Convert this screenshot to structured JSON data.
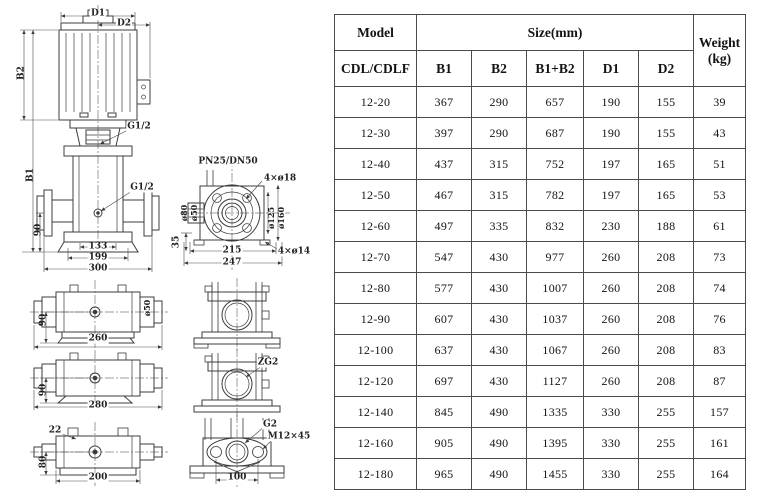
{
  "table": {
    "header": {
      "model": "Model",
      "model_sub": "CDL/CDLF",
      "size_group": "Size(mm)",
      "size_cols": [
        "B1",
        "B2",
        "B1+B2",
        "D1",
        "D2"
      ],
      "weight_l1": "Weight",
      "weight_l2": "(kg)"
    },
    "rows": [
      {
        "model": "12-20",
        "b1": "367",
        "b2": "290",
        "b1b2": "657",
        "d1": "190",
        "d2": "155",
        "w": "39"
      },
      {
        "model": "12-30",
        "b1": "397",
        "b2": "290",
        "b1b2": "687",
        "d1": "190",
        "d2": "155",
        "w": "43"
      },
      {
        "model": "12-40",
        "b1": "437",
        "b2": "315",
        "b1b2": "752",
        "d1": "197",
        "d2": "165",
        "w": "51"
      },
      {
        "model": "12-50",
        "b1": "467",
        "b2": "315",
        "b1b2": "782",
        "d1": "197",
        "d2": "165",
        "w": "53"
      },
      {
        "model": "12-60",
        "b1": "497",
        "b2": "335",
        "b1b2": "832",
        "d1": "230",
        "d2": "188",
        "w": "61"
      },
      {
        "model": "12-70",
        "b1": "547",
        "b2": "430",
        "b1b2": "977",
        "d1": "260",
        "d2": "208",
        "w": "73"
      },
      {
        "model": "12-80",
        "b1": "577",
        "b2": "430",
        "b1b2": "1007",
        "d1": "260",
        "d2": "208",
        "w": "74"
      },
      {
        "model": "12-90",
        "b1": "607",
        "b2": "430",
        "b1b2": "1037",
        "d1": "260",
        "d2": "208",
        "w": "76"
      },
      {
        "model": "12-100",
        "b1": "637",
        "b2": "430",
        "b1b2": "1067",
        "d1": "260",
        "d2": "208",
        "w": "83"
      },
      {
        "model": "12-120",
        "b1": "697",
        "b2": "430",
        "b1b2": "1127",
        "d1": "260",
        "d2": "208",
        "w": "87"
      },
      {
        "model": "12-140",
        "b1": "845",
        "b2": "490",
        "b1b2": "1335",
        "d1": "330",
        "d2": "255",
        "w": "157"
      },
      {
        "model": "12-160",
        "b1": "905",
        "b2": "490",
        "b1b2": "1395",
        "d1": "330",
        "d2": "255",
        "w": "161"
      },
      {
        "model": "12-180",
        "b1": "965",
        "b2": "490",
        "b1b2": "1455",
        "d1": "330",
        "d2": "255",
        "w": "164"
      }
    ]
  },
  "drawings": {
    "front_view": {
      "d1": "D1",
      "d2": "D2",
      "b2": "B2",
      "b1": "B1",
      "g12_top": "G1/2",
      "g12_mid": "G1/2",
      "dim90": "90",
      "dim133": "133",
      "dim199": "199",
      "dim300": "300"
    },
    "top_view": {
      "title": "PN25/DN50",
      "bolt18": "4×ø18",
      "dia80": "ø80",
      "dia50": "ø50",
      "dia125": "ø125",
      "dia160": "ø160",
      "dim35": "35",
      "dim215": "215",
      "dim247": "247",
      "bolt14": "4×ø14"
    },
    "side_view_1": {
      "dim90": "90",
      "dim260": "260",
      "dia50": "ø50"
    },
    "side_view_2": {
      "dim90": "90",
      "dim280": "280"
    },
    "side_view_3": {
      "dim22": "22",
      "dim80": "80",
      "dim200": "200"
    },
    "front_small_2": {
      "zg2": "ZG2"
    },
    "oval_flange": {
      "g2": "G2",
      "bolt": "M12×45",
      "dim100": "100"
    }
  }
}
